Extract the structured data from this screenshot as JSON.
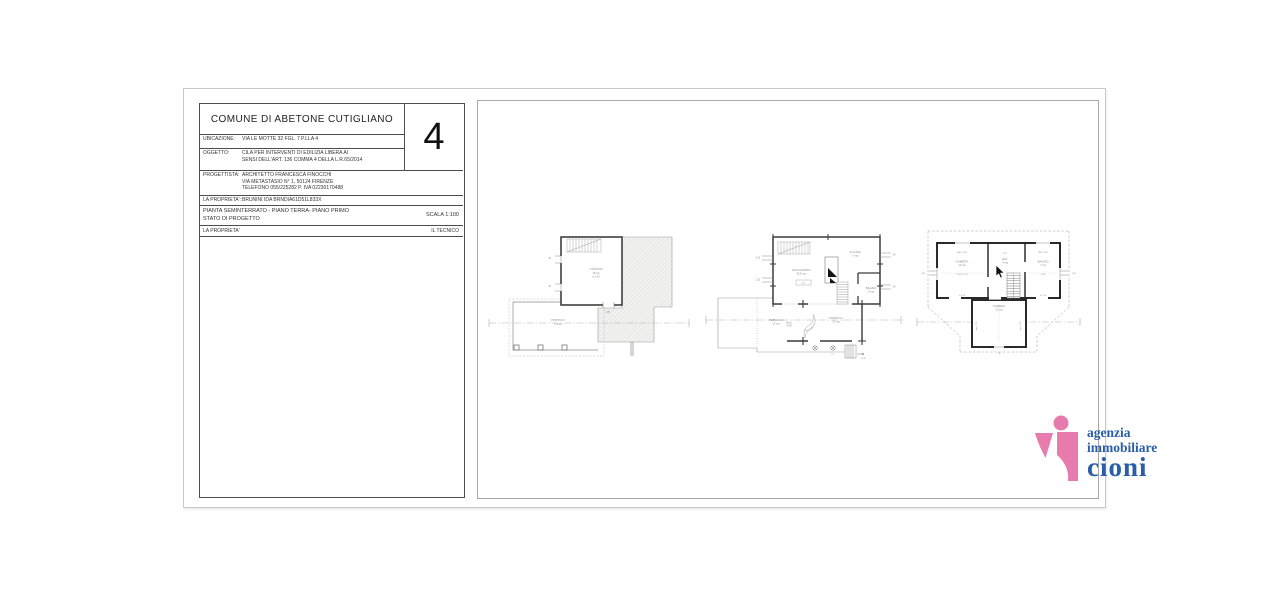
{
  "titleblock": {
    "header": "COMUNE DI ABETONE CUTIGLIANO",
    "sheet_number": "4",
    "ubicazione_label": "UBICAZIONE:",
    "ubicazione_value": "VIA LE MOTTE 32 FGL. 7 P.LLA 4",
    "oggetto_label": "OGGETTO:",
    "oggetto_line1": "CILA PER INTERVENTI DI EDILIZIA LIBERA AI",
    "oggetto_line2": "SENSI DELL'ART. 136 COMMA 4 DELLA L.R.65/2014",
    "progettista_label": "PROGETTISTA:",
    "progettista_line1": "ARCHITETTO FRANCESCA FINOCCHI",
    "progettista_line2": "VIA METASTASIO N° 1, 50124 FIRENZE",
    "progettista_line3": "TELEFONO 055/225282 P. IVA 02230170488",
    "proprieta_label": "LA PROPRIETA':",
    "proprieta_value": "BRUNINI IDA BRNDIA61D51L833X",
    "pianta_line1": "PIANTA SEMINTERRATO - PIANO TERRA- PIANO PRIMO",
    "pianta_line2": "STATO DI PROGETTO",
    "scala": "SCALA 1:100",
    "firma_proprieta": "LA PROPRIETA'",
    "firma_tecnico": "IL TECNICO"
  },
  "plans": {
    "seminterrato": {
      "room_label": "CANTINA",
      "room_area": "15 mq",
      "room_height": "h 2.20",
      "porch_label": "PORTICO",
      "porch_height": "h 2.20",
      "door_dim": "235",
      "window_dim_1": "90",
      "window_dim_2": "90"
    },
    "piano_terra": {
      "soggiorno_label": "SOGGIORNO",
      "soggiorno_area": "28.5 mq",
      "radiator_label": "rad.",
      "cucina_label": "CUCINA",
      "cucina_area": "7 mq",
      "bagno_label": "BAGNO",
      "bagno_area": "5 mq",
      "pergola_label": "PERGOLA",
      "pergola_area": "13 mq",
      "portico_label": "PORTICO",
      "portico_area": "21 mq",
      "quota_label": "+0.45",
      "drain_label": "p.c.",
      "win_left_1": "120",
      "win_left_2": "120",
      "win_right_1": "90",
      "win_right_2": "90"
    },
    "piano_primo": {
      "camera_dim_top": "480 x 315",
      "camera_label": "CAMERA",
      "camera_area": "14 mq",
      "camera_dim_mid": "5.16 x 2.78",
      "camera_dim_bottom": "h 2.70",
      "dis_quota": "4.01",
      "dis_label": "DIS.",
      "dis_area": "4 mq",
      "bagno_dim_top": "360 x 315",
      "bagno_label": "BAGNO",
      "bagno_area": "7 mq",
      "bagno_dim_mid": "2.95",
      "bagno_dim_bottom": "h 2.70",
      "camera2_label": "CAMERA",
      "camera2_area": "11 mq",
      "camera2_dim_left": "sup. 2.70",
      "camera2_dim_right": "sup. 2.70",
      "tick_left": "135",
      "tick_right": "135",
      "bottom_dim": "90"
    }
  },
  "logo": {
    "line1": "agenzia",
    "line2": "immobiliare",
    "line3": "cioni",
    "pink": "#e87bad",
    "blue": "#2a5ea8"
  }
}
